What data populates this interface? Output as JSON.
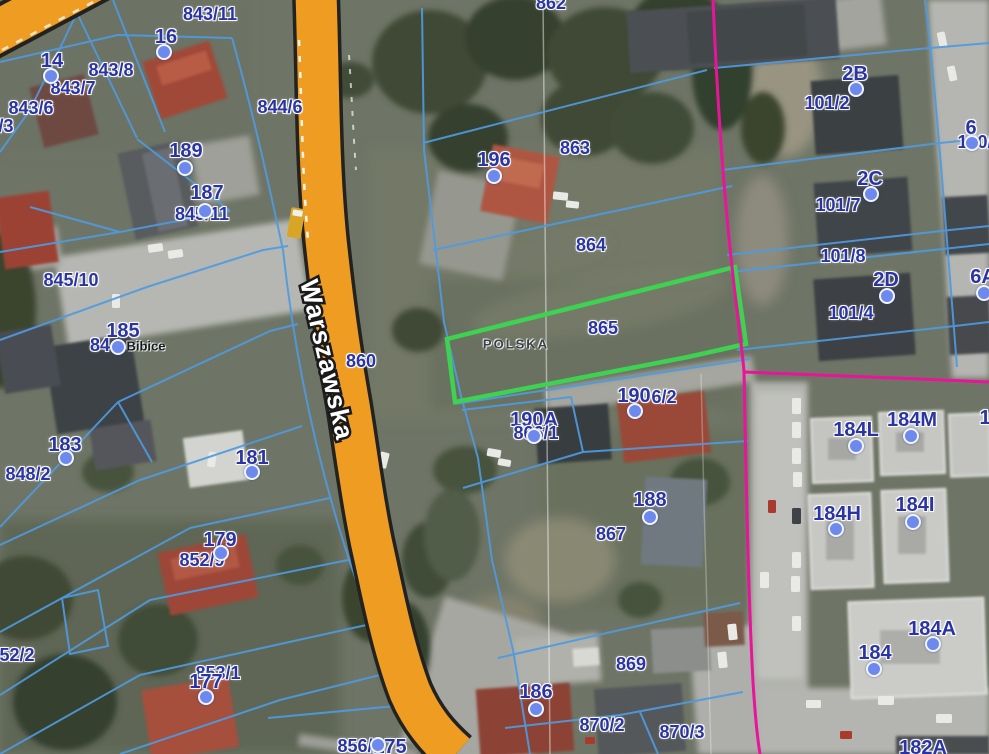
{
  "map": {
    "street": {
      "name": "Warszawska"
    },
    "place_label": {
      "text": "Bibice"
    },
    "selected_parcel": {
      "number": "865",
      "area_label": "POLSKA"
    },
    "colors": {
      "label_blue": "#2a35a3",
      "place_black": "#15181d",
      "area_gray": "#3c4148",
      "parcel_line": "#4f9be0",
      "road_fill": "#ee9c22",
      "road_casing": "#222220",
      "selected_outline": "#3ed152",
      "boundary": "#e8149a",
      "marker_fill": "#6d89ee",
      "marker_ring": "#f2f4fb",
      "street_text": "#ffffff"
    },
    "labels": [
      [
        "843/11",
        210,
        14,
        "p"
      ],
      [
        "16",
        166,
        37,
        "h"
      ],
      [
        "14",
        52,
        61,
        "h"
      ],
      [
        "843/8",
        111,
        70,
        "p"
      ],
      [
        "843/7",
        73,
        88,
        "p"
      ],
      [
        "843/6",
        31,
        108,
        "p"
      ],
      [
        "/3",
        6,
        126,
        "p"
      ],
      [
        "844/6",
        280,
        107,
        "p"
      ],
      [
        "189",
        186,
        151,
        "h"
      ],
      [
        "187",
        207,
        193,
        "h"
      ],
      [
        "845/11",
        202,
        214,
        "p"
      ],
      [
        "845/10",
        71,
        280,
        "p"
      ],
      [
        "185",
        123,
        331,
        "h"
      ],
      [
        "84",
        100,
        345,
        "p"
      ],
      [
        "Bibice",
        146,
        346,
        "pl"
      ],
      [
        "183",
        65,
        445,
        "h"
      ],
      [
        "848/2",
        28,
        474,
        "p"
      ],
      [
        "181",
        252,
        458,
        "h"
      ],
      [
        "179",
        220,
        540,
        "h"
      ],
      [
        "852/9",
        202,
        560,
        "p"
      ],
      [
        "52/2",
        17,
        655,
        "p"
      ],
      [
        "853/1",
        218,
        673,
        "p"
      ],
      [
        "177",
        206,
        682,
        "h"
      ],
      [
        "856/1",
        360,
        746,
        "p"
      ],
      [
        "175",
        390,
        747,
        "h"
      ],
      [
        "860",
        361,
        361,
        "p"
      ],
      [
        "862",
        551,
        3,
        "p"
      ],
      [
        "196",
        494,
        160,
        "h"
      ],
      [
        "863",
        575,
        148,
        "p"
      ],
      [
        "864",
        591,
        245,
        "p"
      ],
      [
        "865",
        603,
        328,
        "p"
      ],
      [
        "POLSKA",
        516,
        344,
        "ar"
      ],
      [
        "190A",
        534,
        420,
        "h"
      ],
      [
        "866/1",
        536,
        433,
        "p"
      ],
      [
        "190",
        634,
        396,
        "h"
      ],
      [
        "6/2",
        664,
        397,
        "p"
      ],
      [
        "188",
        650,
        500,
        "h"
      ],
      [
        "867",
        611,
        534,
        "p"
      ],
      [
        "869",
        631,
        664,
        "p"
      ],
      [
        "186",
        536,
        692,
        "h"
      ],
      [
        "870/2",
        602,
        725,
        "p"
      ],
      [
        "870/3",
        682,
        732,
        "p"
      ],
      [
        "2B",
        855,
        74,
        "h"
      ],
      [
        "101/2",
        827,
        103,
        "p"
      ],
      [
        "6",
        971,
        128,
        "h"
      ],
      [
        "100/",
        975,
        142,
        "p"
      ],
      [
        "2C",
        870,
        179,
        "h"
      ],
      [
        "101/7",
        838,
        205,
        "p"
      ],
      [
        "101/8",
        843,
        256,
        "p"
      ],
      [
        "2D",
        886,
        280,
        "h"
      ],
      [
        "101/4",
        851,
        313,
        "p"
      ],
      [
        "6A",
        983,
        277,
        "h"
      ],
      [
        "184L",
        856,
        430,
        "h"
      ],
      [
        "184M",
        912,
        420,
        "h"
      ],
      [
        "1",
        985,
        418,
        "h"
      ],
      [
        "184H",
        837,
        514,
        "h"
      ],
      [
        "184I",
        915,
        505,
        "h"
      ],
      [
        "184A",
        932,
        629,
        "h"
      ],
      [
        "184",
        875,
        653,
        "h"
      ],
      [
        "182A",
        923,
        748,
        "h"
      ]
    ],
    "markers": [
      [
        51,
        76
      ],
      [
        164,
        52
      ],
      [
        185,
        168
      ],
      [
        205,
        211
      ],
      [
        118,
        347
      ],
      [
        66,
        458
      ],
      [
        252,
        472
      ],
      [
        221,
        553
      ],
      [
        206,
        697
      ],
      [
        378,
        745
      ],
      [
        494,
        176
      ],
      [
        534,
        436
      ],
      [
        635,
        411
      ],
      [
        650,
        517
      ],
      [
        536,
        709
      ],
      [
        856,
        89
      ],
      [
        972,
        143
      ],
      [
        871,
        194
      ],
      [
        887,
        296
      ],
      [
        984,
        293
      ],
      [
        856,
        446
      ],
      [
        911,
        436
      ],
      [
        836,
        529
      ],
      [
        913,
        522
      ],
      [
        933,
        644
      ],
      [
        874,
        669
      ]
    ]
  }
}
